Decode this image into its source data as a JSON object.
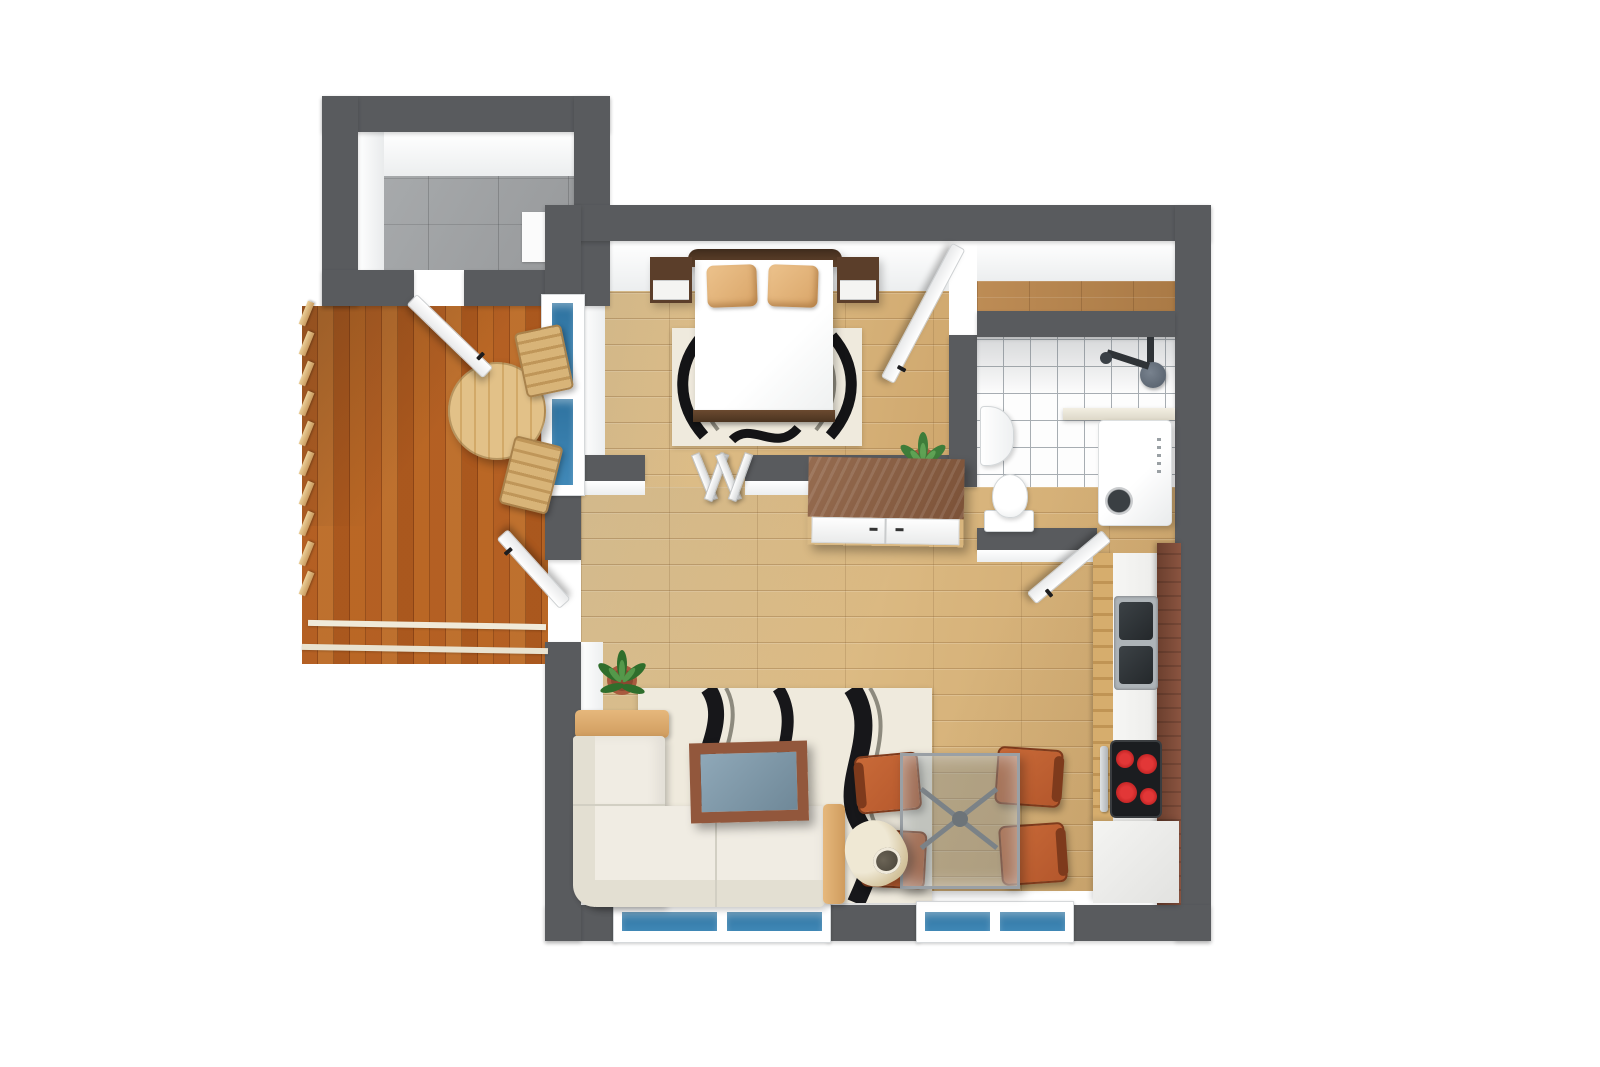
{
  "title": "3D apartment floor plan – top view render",
  "palette": {
    "bg": "#ffffff",
    "wall": "#595b5e",
    "wall_face": "#f3f4f5",
    "wood_light": "#e5c997",
    "wood_mid": "#d9b67e",
    "wood_dark": "#c8a066",
    "deck_a": "#d69c5e",
    "deck_b": "#e3b87c",
    "deck_c": "#cb8f50",
    "hall_wood": "#b5834f",
    "concrete": "#a3a6a8",
    "tile_line": "#a7adb2",
    "glass": "#2e729f",
    "glass2": "#4189b8",
    "rug": "#efeadd",
    "rug_ink": "#17171a",
    "sofa": "#f0ece3",
    "sofa_shade": "#e3dfd2",
    "trim": "#d9a96e",
    "dark_wood": "#5a3c28",
    "side_top": "#8a6148",
    "chair": "#b4572c",
    "chair_dk": "#7e3a1c",
    "bamboo": "#d2a968",
    "panel": "#7c4a36",
    "sink": "#33383c",
    "stove": "#1b1d20",
    "burner": "#ce1f1f",
    "lamp": "#dccda9",
    "plant": "#3e7d3a",
    "pot": "#a85a3e",
    "glass_table": "#7f98a8"
  },
  "rooms": [
    {
      "id": "storage",
      "label": "Storage room",
      "floor": "concrete"
    },
    {
      "id": "balcony",
      "label": "Balcony terrace",
      "floor": "wood deck"
    },
    {
      "id": "bedroom",
      "label": "Bedroom",
      "floor": "wood"
    },
    {
      "id": "bathroom",
      "label": "Bathroom",
      "floor": "white tile"
    },
    {
      "id": "hall",
      "label": "Hallway",
      "floor": "wood"
    },
    {
      "id": "living",
      "label": "Living room",
      "floor": "wood"
    },
    {
      "id": "kitchen",
      "label": "Kitchen / dining",
      "floor": "wood"
    }
  ],
  "labels": {
    "storage_room": "Storage room",
    "storage_mat": "Storage mat",
    "balcony": "Balcony terrace",
    "railing": "Balcony railing",
    "balcony_table": "Round wooden balcony table",
    "balcony_chair": "Wooden balcony chair",
    "storage_door": "Open door to storage room",
    "balcony_door": "Open door to balcony",
    "balcony_window": "Glazed balcony door (blue glass)",
    "bedroom": "Bedroom",
    "double_bed": "Double bed",
    "headboard": "Headboard",
    "footboard": "Footboard",
    "pillow": "Pillow",
    "nightstand": "Nightstand",
    "bedroom_rug": "Bedroom rug with black wave pattern",
    "folding_screen": "Folding screen",
    "potted_plant": "Potted plant",
    "bedroom_door": "Open bedroom door",
    "sideboard": "Sideboard cabinet",
    "bathroom": "Bathroom",
    "washbasin": "Washbasin",
    "toilet": "Toilet",
    "washing_machine": "Washing machine",
    "shower": "Shower set",
    "shower_glass": "Shower glass screen",
    "bathroom_door": "Open bathroom door",
    "living_room": "Living room",
    "sofa": "L-shaped sofa",
    "coffee_table": "Coffee table with glass top",
    "living_rug": "Living room rug with black wave pattern",
    "floor_lamp": "Floor lamp",
    "dining_table": "Glass dining table",
    "dining_chair": "Dining chair",
    "kitchen_counter": "Kitchen counter",
    "kitchen_sink": "Double kitchen sink",
    "stove": "Cooktop with four burners",
    "oven_handle": "Oven handle",
    "counter_panel": "Dark wood counter panel",
    "end_cabinet": "Kitchen end cabinet",
    "window": "Window with blue glass"
  }
}
